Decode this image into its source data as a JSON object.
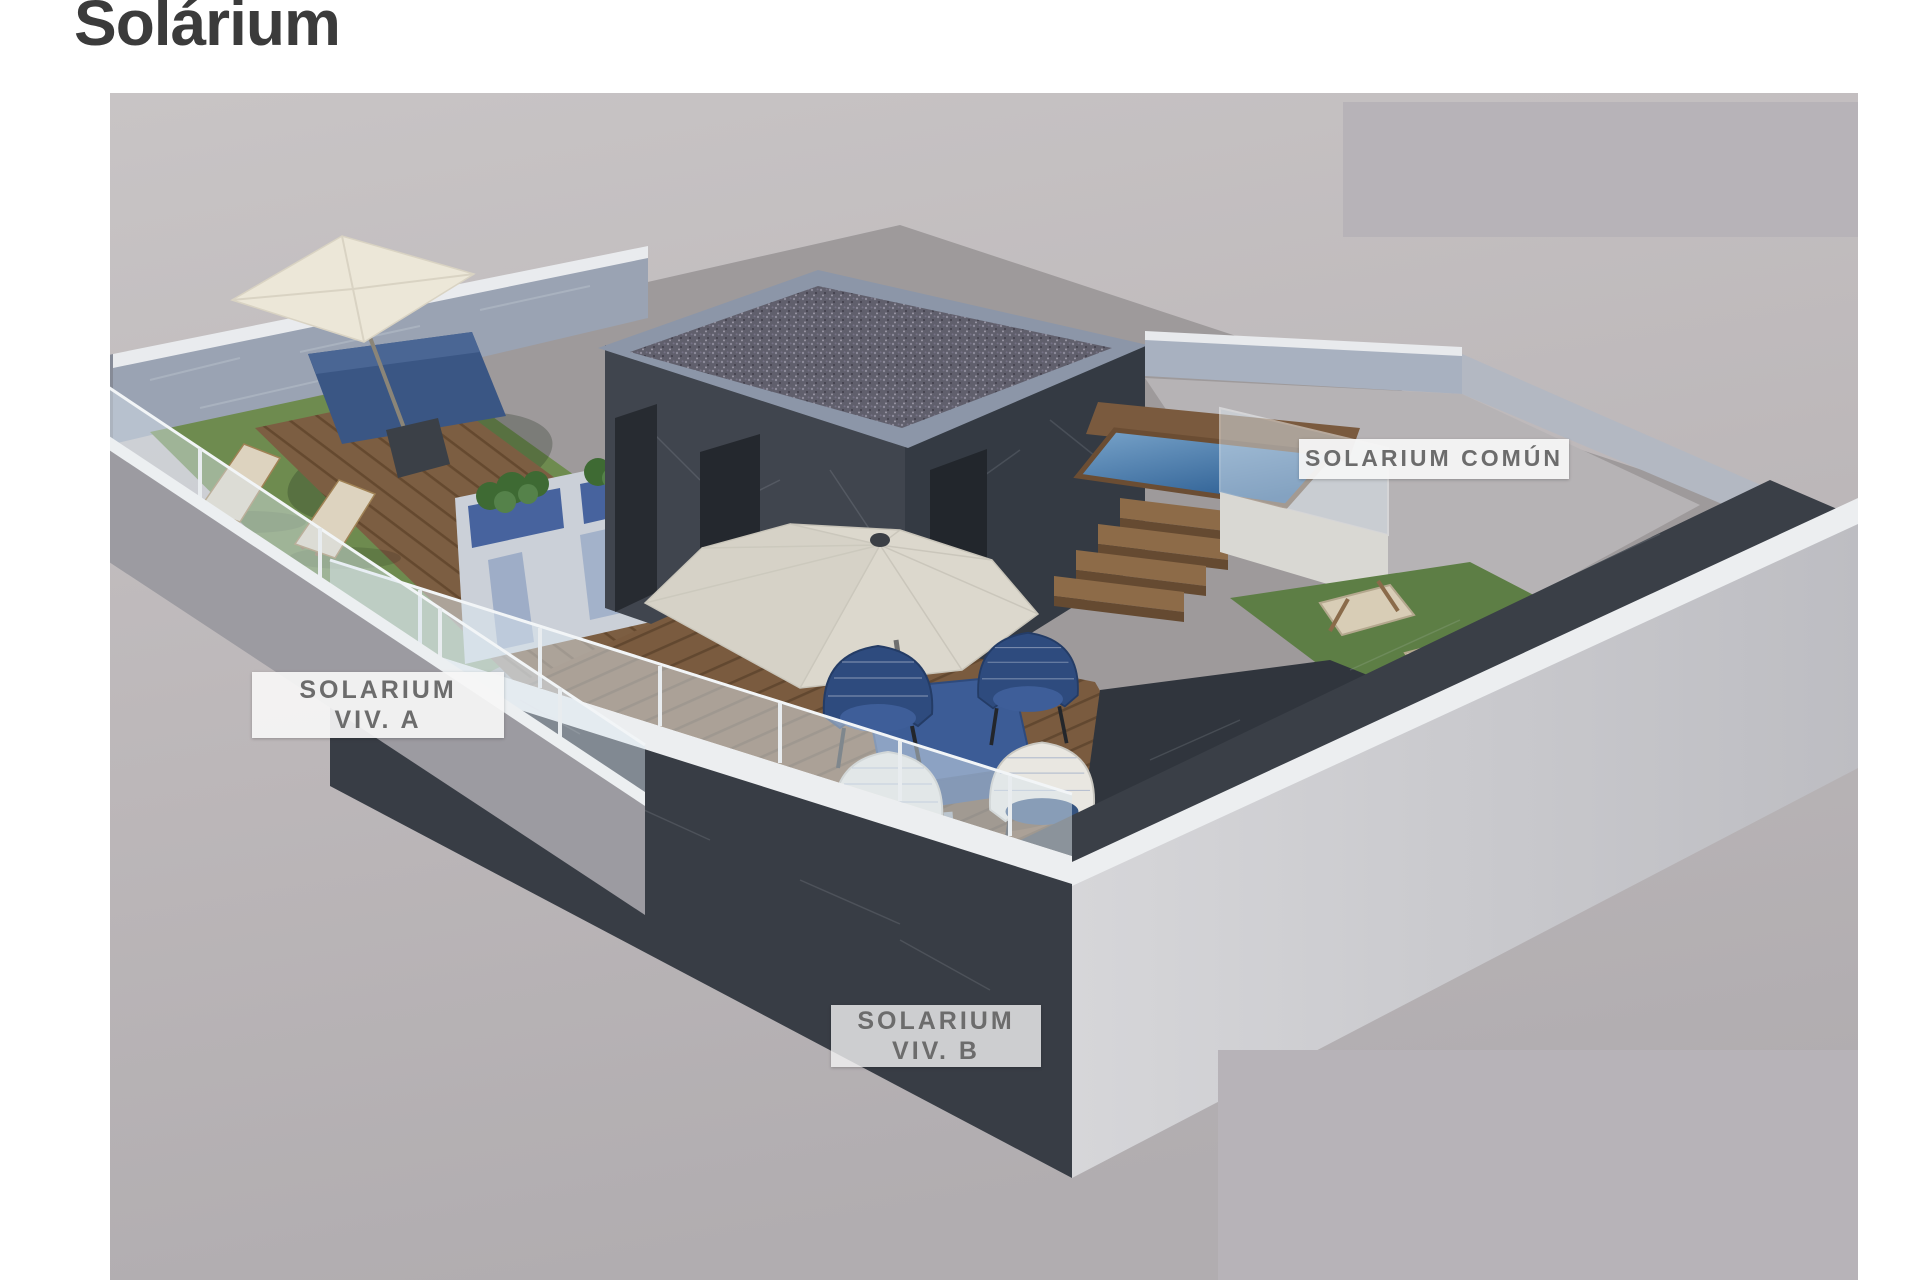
{
  "page": {
    "title": "Solárium"
  },
  "render": {
    "description": "3d-rooftop-solarium-render",
    "labels": {
      "common": "SOLARIUM COMÚN",
      "viv_a": {
        "line1": "SOLARIUM",
        "line2": "VIV. A"
      },
      "viv_b": {
        "line1": "SOLARIUM",
        "line2": "VIV. B"
      }
    }
  },
  "colors": {
    "page_bg": "#ffffff",
    "title_text": "#3b3b3b",
    "label_text": "#6c6c6c",
    "label_bg": "#f3f3f3",
    "render_bg": "#c0bbbd",
    "redacted_block": "#b7b3b8",
    "building_wall_dark": "#3f444d",
    "roof_gravel": "#605f6c",
    "deck_wood": "#7b5d41",
    "grass_green": "#678a4b",
    "pool_water": "#3f6fa0",
    "glass_railing": "#dce7f0",
    "furniture_blue": "#3a5684",
    "umbrella_cream": "#e9e4d6"
  }
}
